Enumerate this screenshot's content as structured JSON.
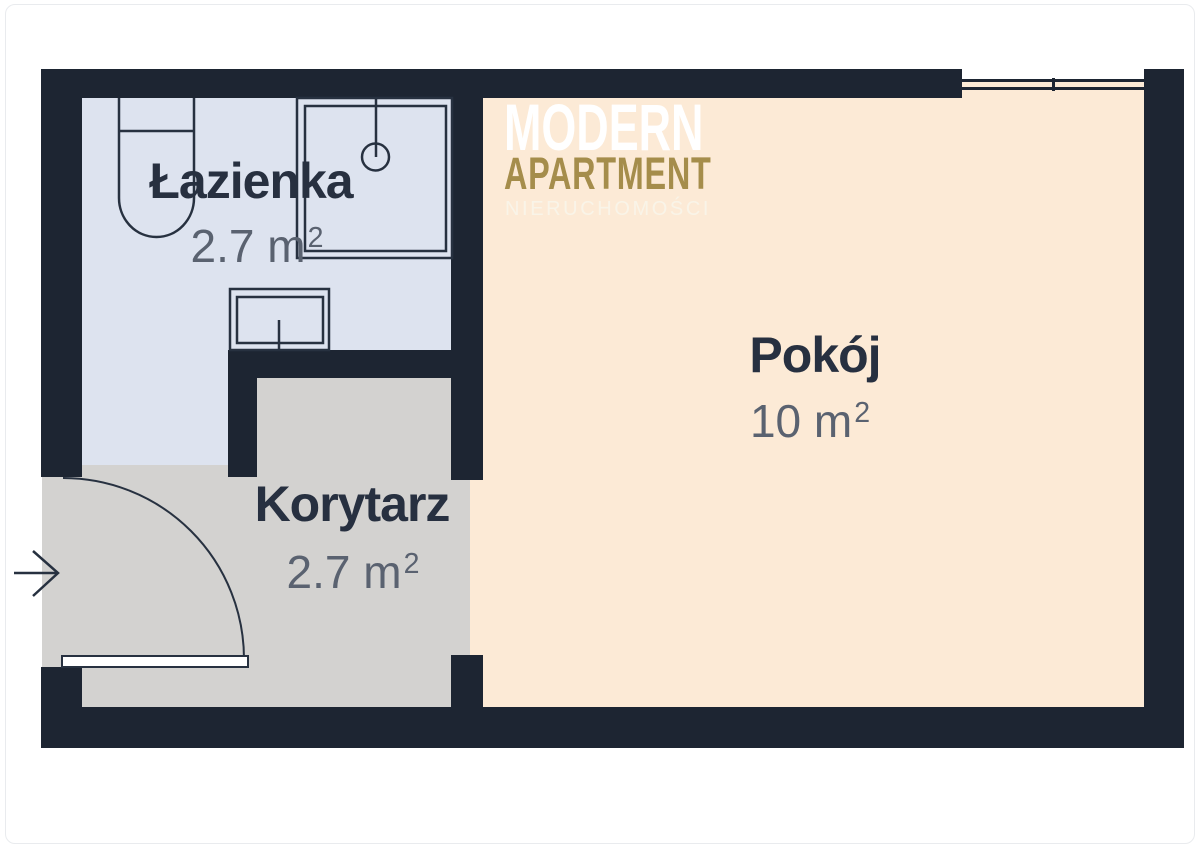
{
  "brand": {
    "line1": "MODERN",
    "line2": "APARTMENT",
    "line3": "NIERUCHOMOŚCI"
  },
  "rooms": [
    {
      "id": "lazienka",
      "name": "Łazienka",
      "area_value": "2.7 m",
      "area_sup": "2"
    },
    {
      "id": "korytarz",
      "name": "Korytarz",
      "area_value": "2.7 m",
      "area_sup": "2"
    },
    {
      "id": "pokoj",
      "name": "Pokój",
      "area_value": "10 m",
      "area_sup": "2"
    }
  ],
  "fixtures": {
    "bathroom": [
      "toilet",
      "shower-cabin",
      "sink"
    ],
    "room": [
      "window"
    ],
    "entrance": [
      "entrance-door-swing",
      "entrance-arrow"
    ]
  },
  "colors": {
    "wall": "#1d2532",
    "line": "#273140",
    "floor_bath": "#dde3ef",
    "floor_corridor": "#d3d2d0",
    "floor_room": "#fcead6",
    "gold": "#a58d4b",
    "label": "#273040",
    "area": "#5a6270"
  }
}
